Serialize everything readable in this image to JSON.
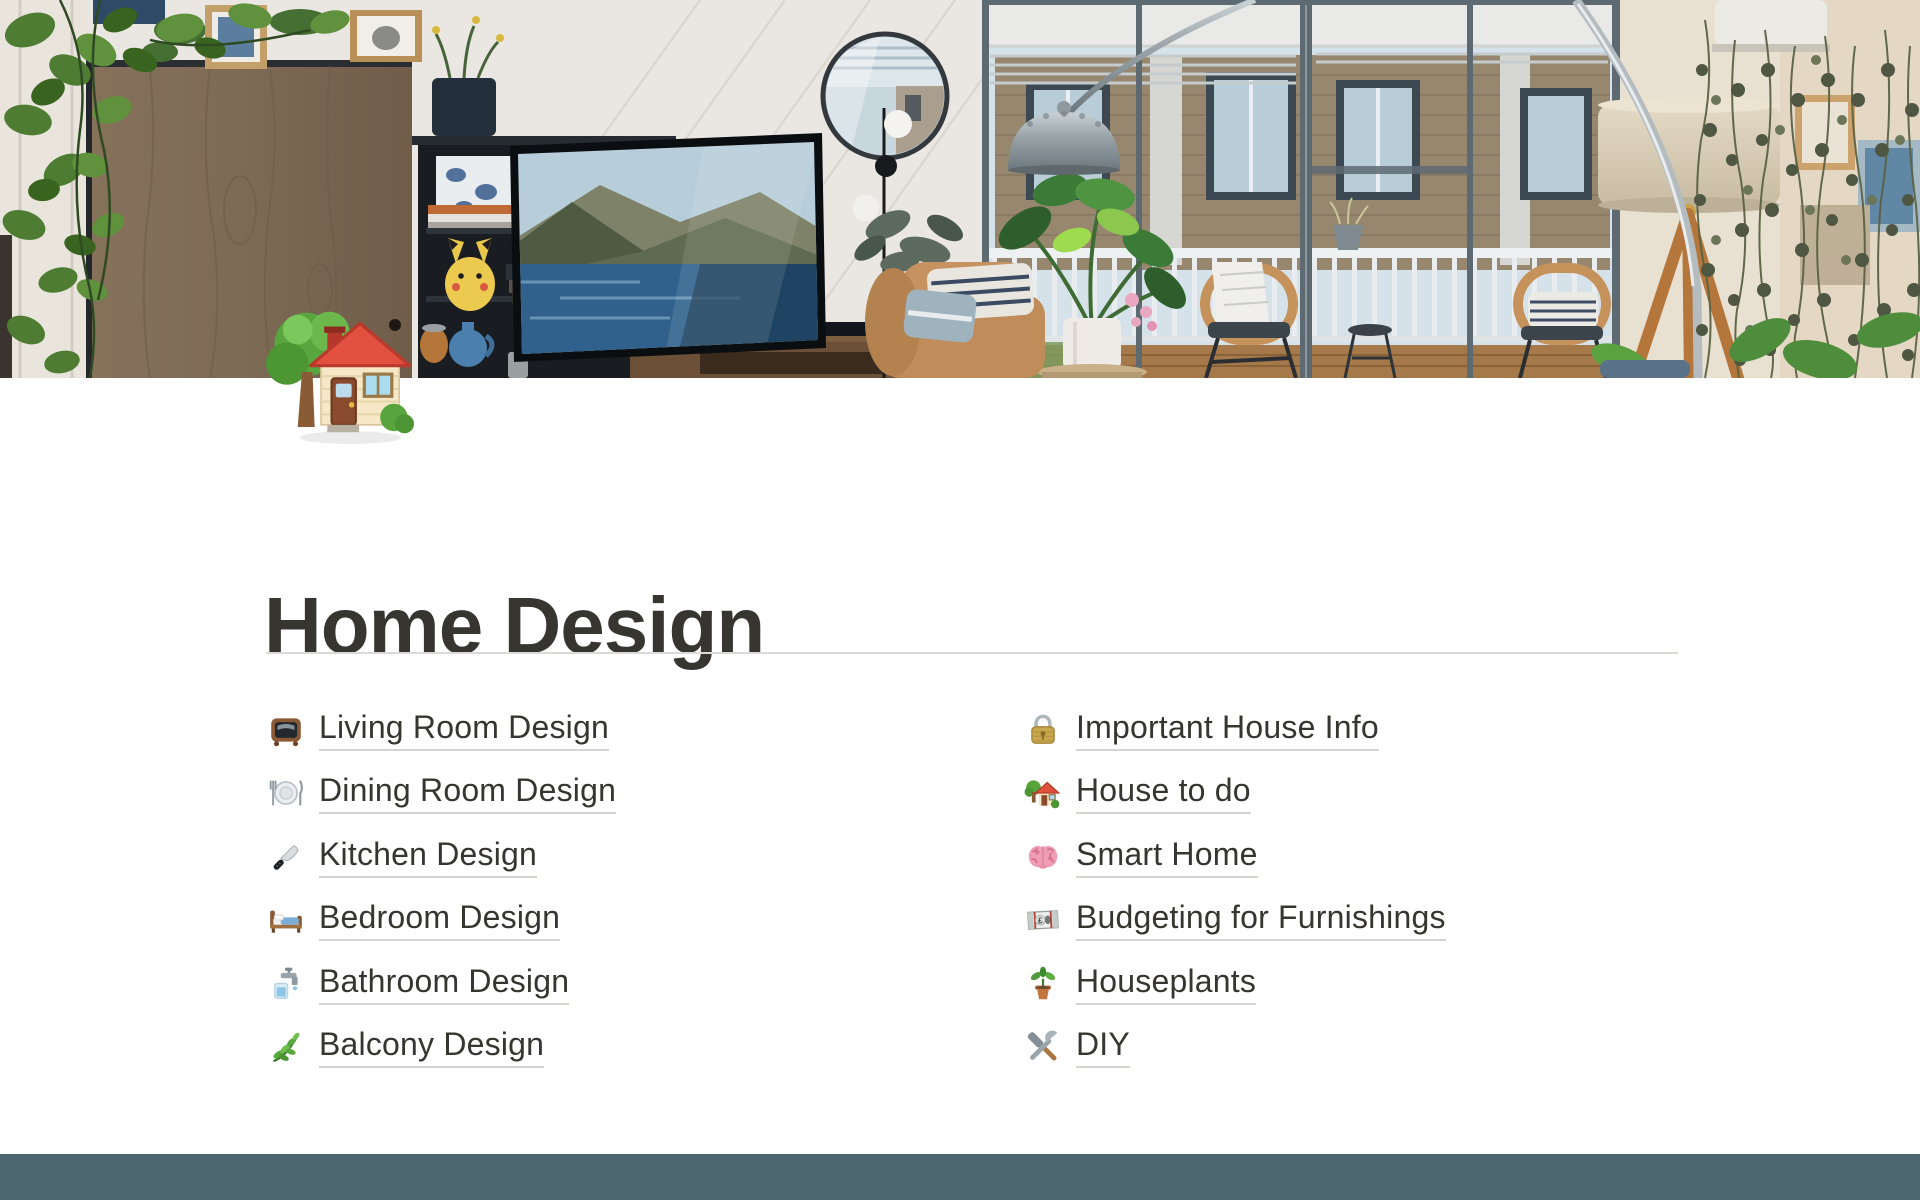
{
  "page": {
    "title": "Home Design",
    "icon": "house-with-garden",
    "cover": "living-room-photo"
  },
  "links": {
    "left": [
      {
        "icon": "tv-icon",
        "label": "Living Room Design"
      },
      {
        "icon": "fork-knife-plate-icon",
        "label": "Dining Room Design"
      },
      {
        "icon": "kitchen-knife-icon",
        "label": "Kitchen Design"
      },
      {
        "icon": "bed-icon",
        "label": "Bedroom Design"
      },
      {
        "icon": "potable-water-icon",
        "label": "Bathroom Design"
      },
      {
        "icon": "herb-icon",
        "label": "Balcony Design"
      }
    ],
    "right": [
      {
        "icon": "lock-icon",
        "label": "Important House Info"
      },
      {
        "icon": "house-garden-icon",
        "label": "House to do"
      },
      {
        "icon": "brain-icon",
        "label": "Smart Home"
      },
      {
        "icon": "pound-banknote-icon",
        "label": "Budgeting for Furnishings"
      },
      {
        "icon": "potted-plant-icon",
        "label": "Houseplants"
      },
      {
        "icon": "hammer-wrench-icon",
        "label": "DIY"
      }
    ]
  },
  "colors": {
    "title_text": "#37352F",
    "link_underline": "#D6D4D0",
    "divider": "#DBDAD7",
    "bottom_bar": "#4C6770"
  }
}
